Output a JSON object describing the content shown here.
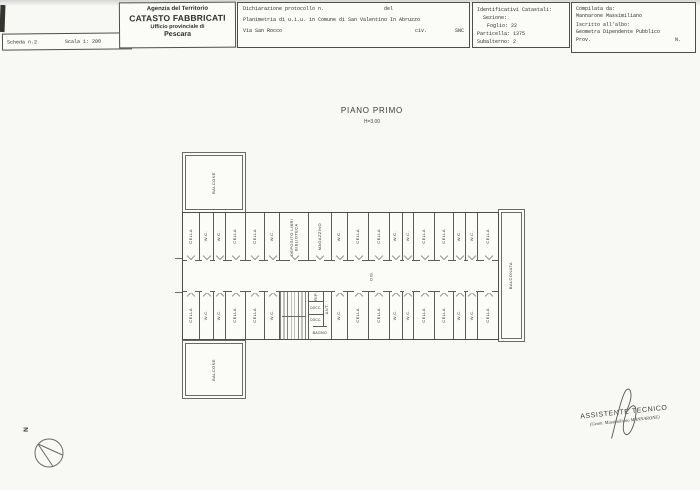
{
  "scan": {
    "compass_label": "N"
  },
  "header": {
    "scheda_box": {
      "scheda": "Scheda n.2",
      "scala": "Scala 1: 200"
    },
    "logo_box": {
      "agency": "Agenzia del Territorio",
      "title": "CATASTO FABBRICATI",
      "office": "Ufficio provinciale di",
      "city": "Pescara"
    },
    "declaration_box": {
      "protocol": "Dichiarazione protocollo n.",
      "del": "del",
      "planimetria": "Planimetria di u.i.u. in Comune di San Valentino In Abruzzo",
      "street": "Via San Rocco",
      "civ": "civ.",
      "civ_value": "SNC"
    },
    "catasto_box": {
      "title": "Identificativi Catastali:",
      "sezione": "Sezione:",
      "foglio": "Foglio: 22",
      "particella": "Particella: 1375",
      "subalterno": "Subalterno: 2"
    },
    "compiler_box": {
      "label": "Compilata da:",
      "name": "Mannarone Massimiliano",
      "register_label": "Iscritto all'albo:",
      "register_value": "Geometra Dipendente Pubblico",
      "prov": "Prov.",
      "n": "N."
    }
  },
  "plan": {
    "title": "PIANO PRIMO",
    "height_label": "H=3.00",
    "balcone_top": "BALCONE",
    "balcone_bottom": "BALCONE",
    "balconata": "BALCONATA",
    "corridor_label": "DIS.",
    "upper_rooms": [
      "CELLA",
      "W.C.",
      "W.C.",
      "CELLA",
      "CELLA",
      "W.C.",
      "DEPOSITO LIBRI BIBLIOTECA",
      "MAGAZZINO",
      "W.C.",
      "CELLA",
      "CELLA",
      "W.C.",
      "W.C.",
      "CELLA",
      "CELLA",
      "W.C.",
      "W.C.",
      "CELLA"
    ],
    "lower_left_rooms": [
      "CELLA",
      "W.C.",
      "W.C.",
      "CELLA",
      "CELLA",
      "W.C."
    ],
    "lower_right_rooms": [
      "W.C.",
      "CELLA",
      "CELLA",
      "W.C.",
      "W.C.",
      "CELLA",
      "CELLA",
      "W.C.",
      "W.C.",
      "CELLA"
    ],
    "services": {
      "rip": "RIP.",
      "docc1": "DOCC.",
      "docc2": "DOCC.",
      "ant": "ANT.",
      "bagno": "BAGNO"
    }
  },
  "footer": {
    "signature_title": "ASSISTENTE TECNICO",
    "signature_name": "(Geom. Massimiliano MANNARONE)"
  }
}
